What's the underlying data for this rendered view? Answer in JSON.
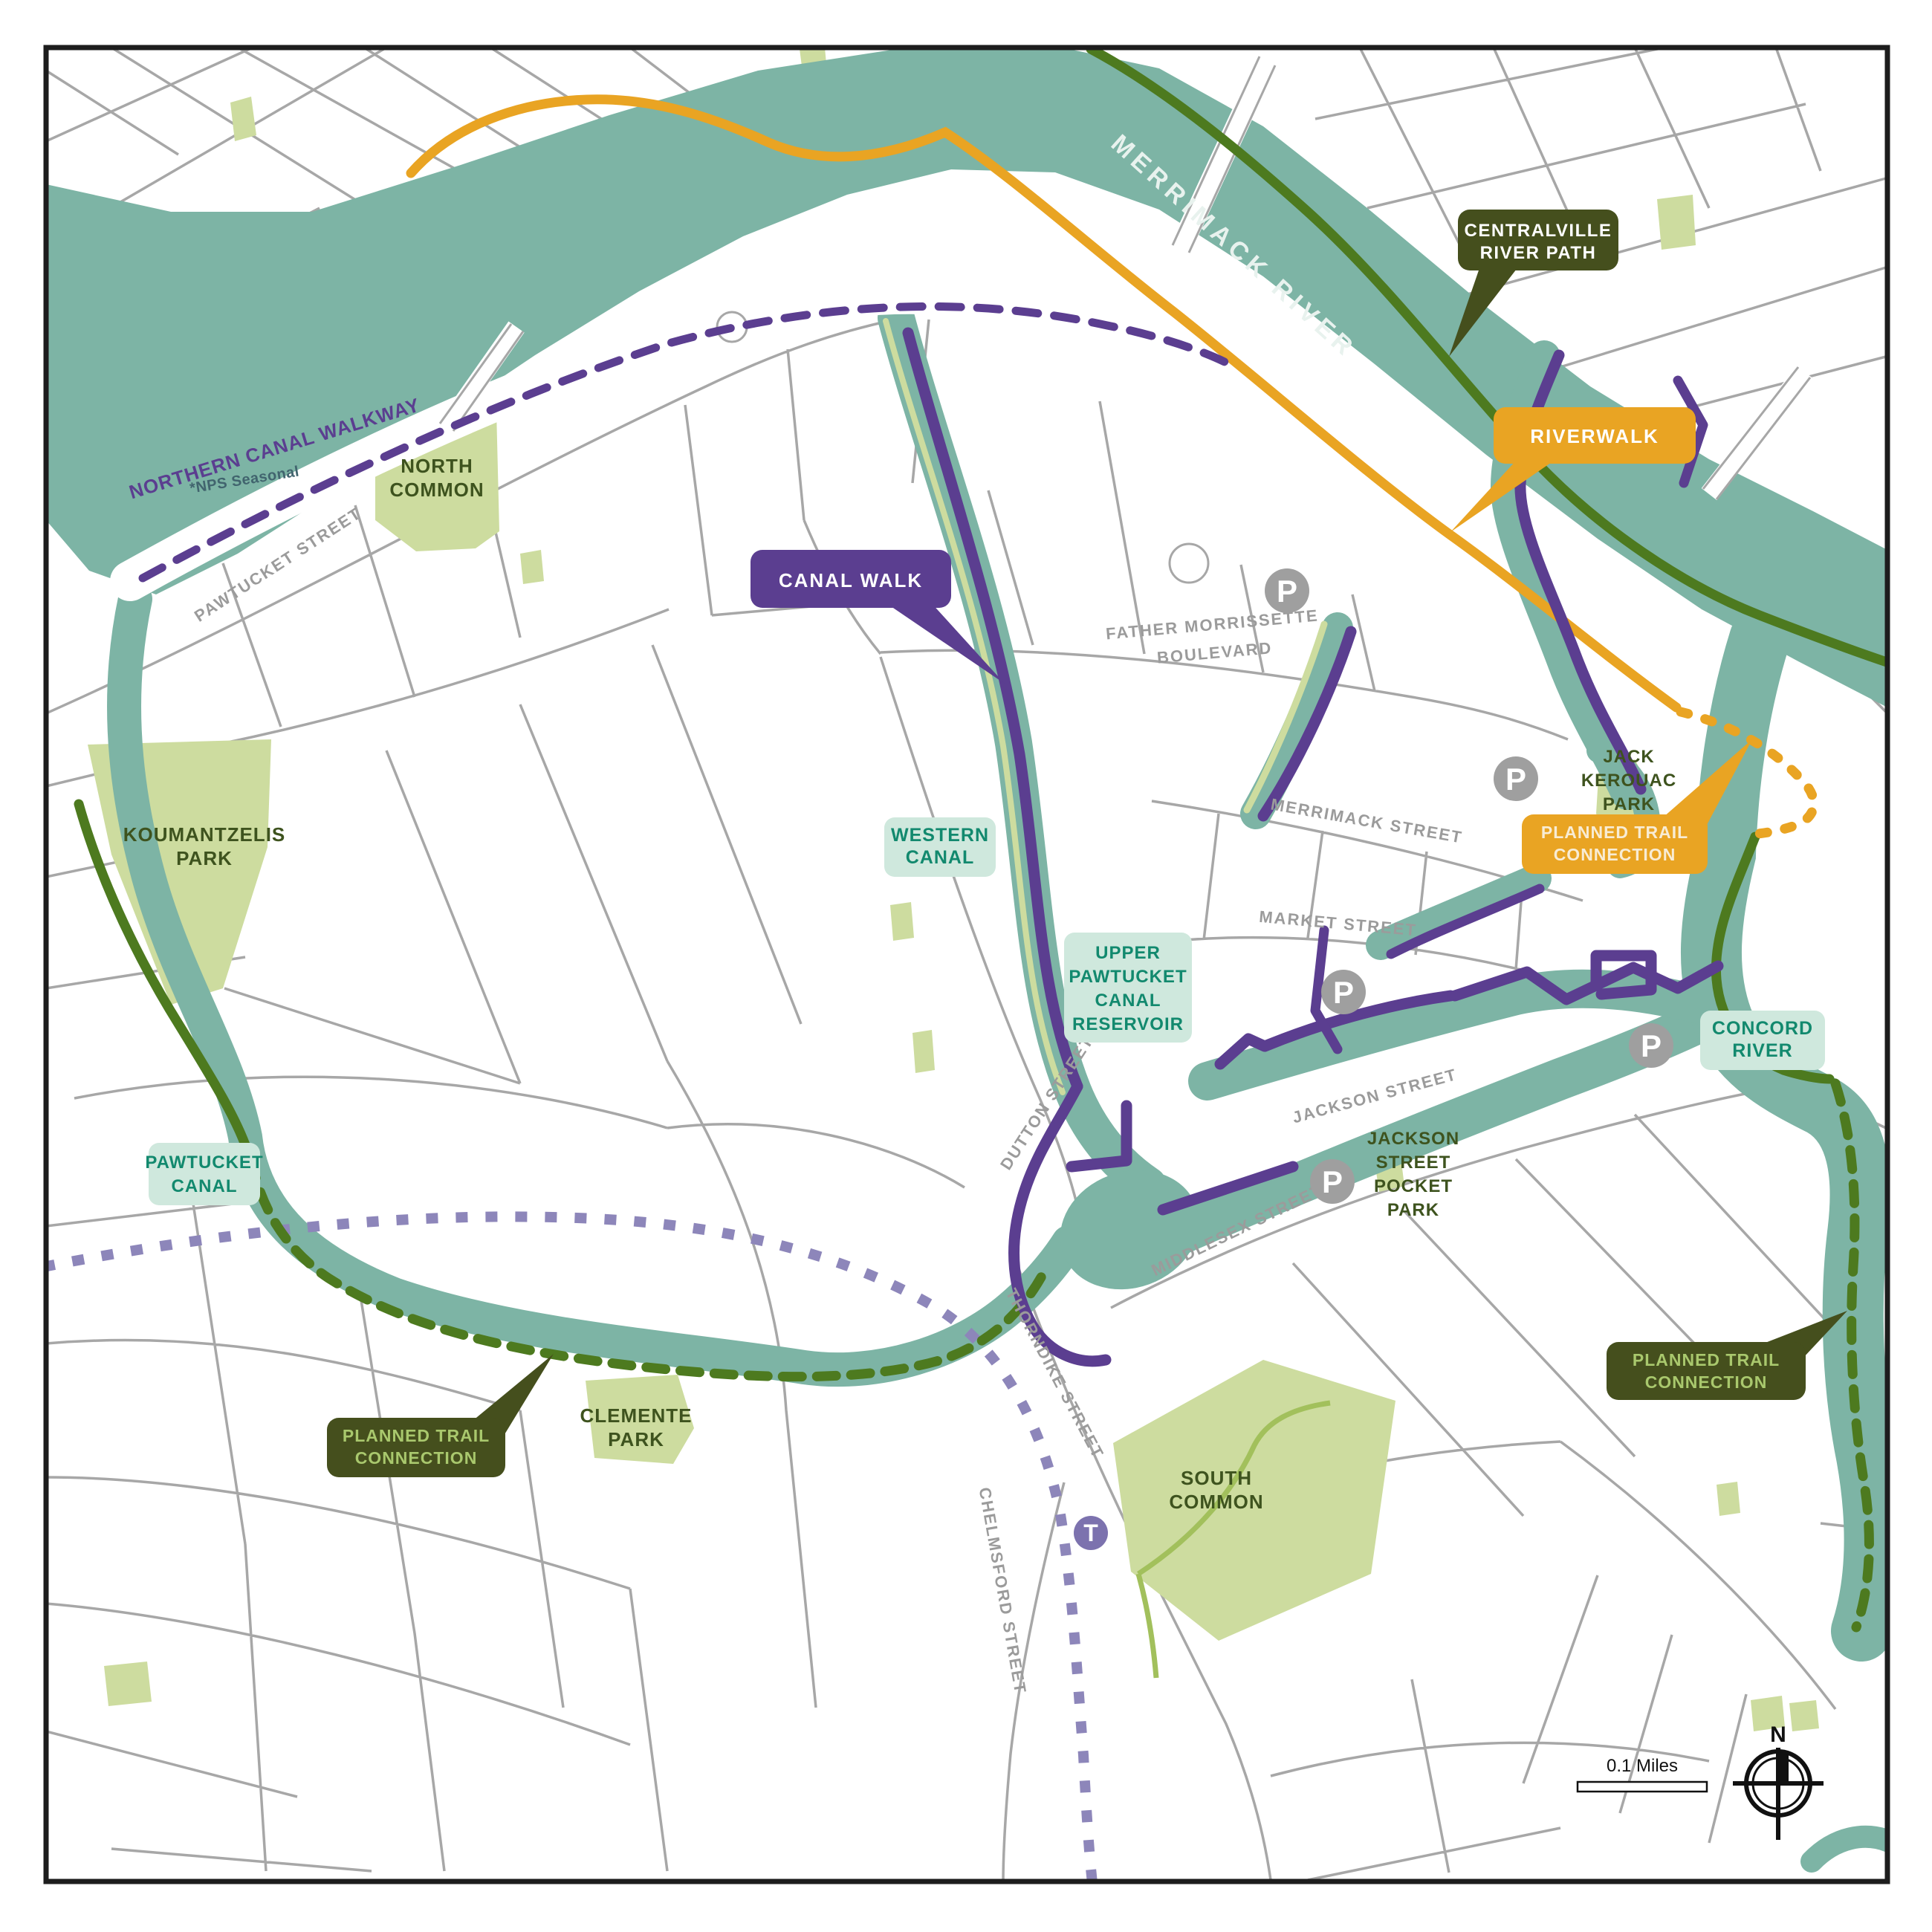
{
  "water_labels": {
    "merrimack_river": "MERRIMACK RIVER",
    "western_canal": [
      "WESTERN",
      "CANAL"
    ],
    "upper_pawtucket": [
      "UPPER",
      "PAWTUCKET",
      "CANAL",
      "RESERVOIR"
    ],
    "pawtucket_canal": [
      "PAWTUCKET",
      "CANAL"
    ],
    "concord_river": [
      "CONCORD",
      "RIVER"
    ]
  },
  "streets": {
    "pawtucket": "PAWTUCKET STREET",
    "father_morrissette": [
      "FATHER MORRISSETTE",
      "BOULEVARD"
    ],
    "merrimack": "MERRIMACK STREET",
    "market": "MARKET STREET",
    "dutton": "DUTTON STREET",
    "jackson": "JACKSON STREET",
    "middlesex": "MIDDLESEX STREET",
    "thorndike": "THORNDIKE STREET",
    "chelmsford": "CHELMSFORD STREET"
  },
  "parks": {
    "north_common": [
      "NORTH",
      "COMMON"
    ],
    "south_common": [
      "SOUTH",
      "COMMON"
    ],
    "koumantzelis": [
      "KOUMANTZELIS",
      "PARK"
    ],
    "clemente": [
      "CLEMENTE",
      "PARK"
    ],
    "jack_kerouac": [
      "JACK",
      "KEROUAC",
      "PARK"
    ],
    "jackson_pocket": [
      "JACKSON",
      "STREET",
      "POCKET",
      "PARK"
    ]
  },
  "trails": {
    "northern_canal_walkway": "NORTHERN CANAL WALKWAY",
    "nps_seasonal": "*NPS Seasonal",
    "canal_walk": "CANAL WALK",
    "riverwalk": "RIVERWALK",
    "centralville": [
      "CENTRALVILLE",
      "RIVER PATH"
    ],
    "planned": [
      "PLANNED TRAIL",
      "CONNECTION"
    ]
  },
  "icons": {
    "parking": "P",
    "transit": "T",
    "compass_north": "N"
  },
  "scale": {
    "label": "0.1 Miles"
  },
  "colors": {
    "water": "#7db4a5",
    "park": "#cddc9f",
    "street": "#a7a7a7",
    "canal_walk_purple": "#5b3e90",
    "riverwalk_orange": "#e9a423",
    "river_path_green": "#4d7a1f",
    "planned_olive": "#454f1d",
    "rail_lavender": "#8d86ba",
    "water_label_teal": "#12896e",
    "water_label_bg": "#cfe8dd",
    "park_label": "#3e531e",
    "street_label": "#9b9b9b",
    "parking_gray": "#9f9f9f",
    "transit_purple": "#7c72ae"
  }
}
